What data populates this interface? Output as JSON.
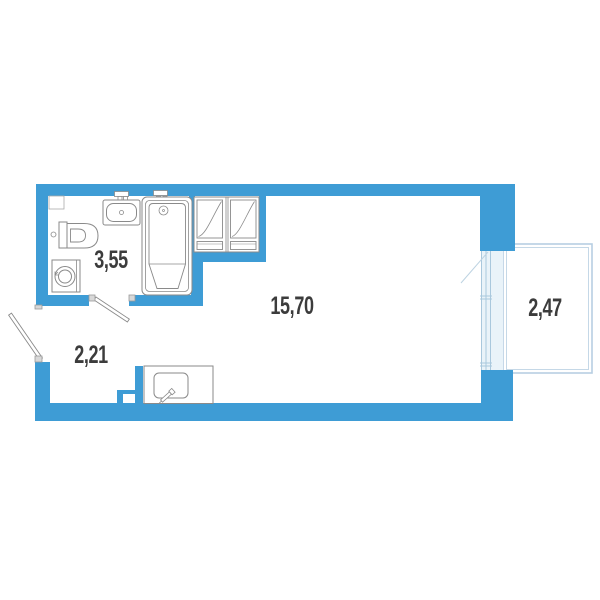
{
  "title": "Studio apartment floor plan",
  "rooms": [
    {
      "id": "bathroom",
      "area_label": "3,55"
    },
    {
      "id": "hallway",
      "area_label": "2,21"
    },
    {
      "id": "living-room",
      "area_label": "15,70"
    },
    {
      "id": "balcony",
      "area_label": "2,47"
    }
  ],
  "fixtures": [
    "sink-icon",
    "toilet-icon",
    "washing-machine-icon",
    "bathtub-icon",
    "vent-shaft-icon",
    "kitchen-sink-icon",
    "entrance-door-icon",
    "bathroom-door-icon",
    "balcony-door-icon"
  ],
  "colors": {
    "bg": "#ffffff",
    "wall": "#3e9cd5",
    "fixture_line": "#8a8a8a",
    "fixture_light": "#aaaaaa",
    "hinge_fill": "#d8d8d8",
    "hinge_line": "#9a9a9a",
    "balcony_line": "#b7cfe2",
    "glazing_fill": "#e9f3f9",
    "glazing_line": "#a9c8dd",
    "swing_line": "#bdd3e2",
    "label_text": "#3c3c3c"
  }
}
